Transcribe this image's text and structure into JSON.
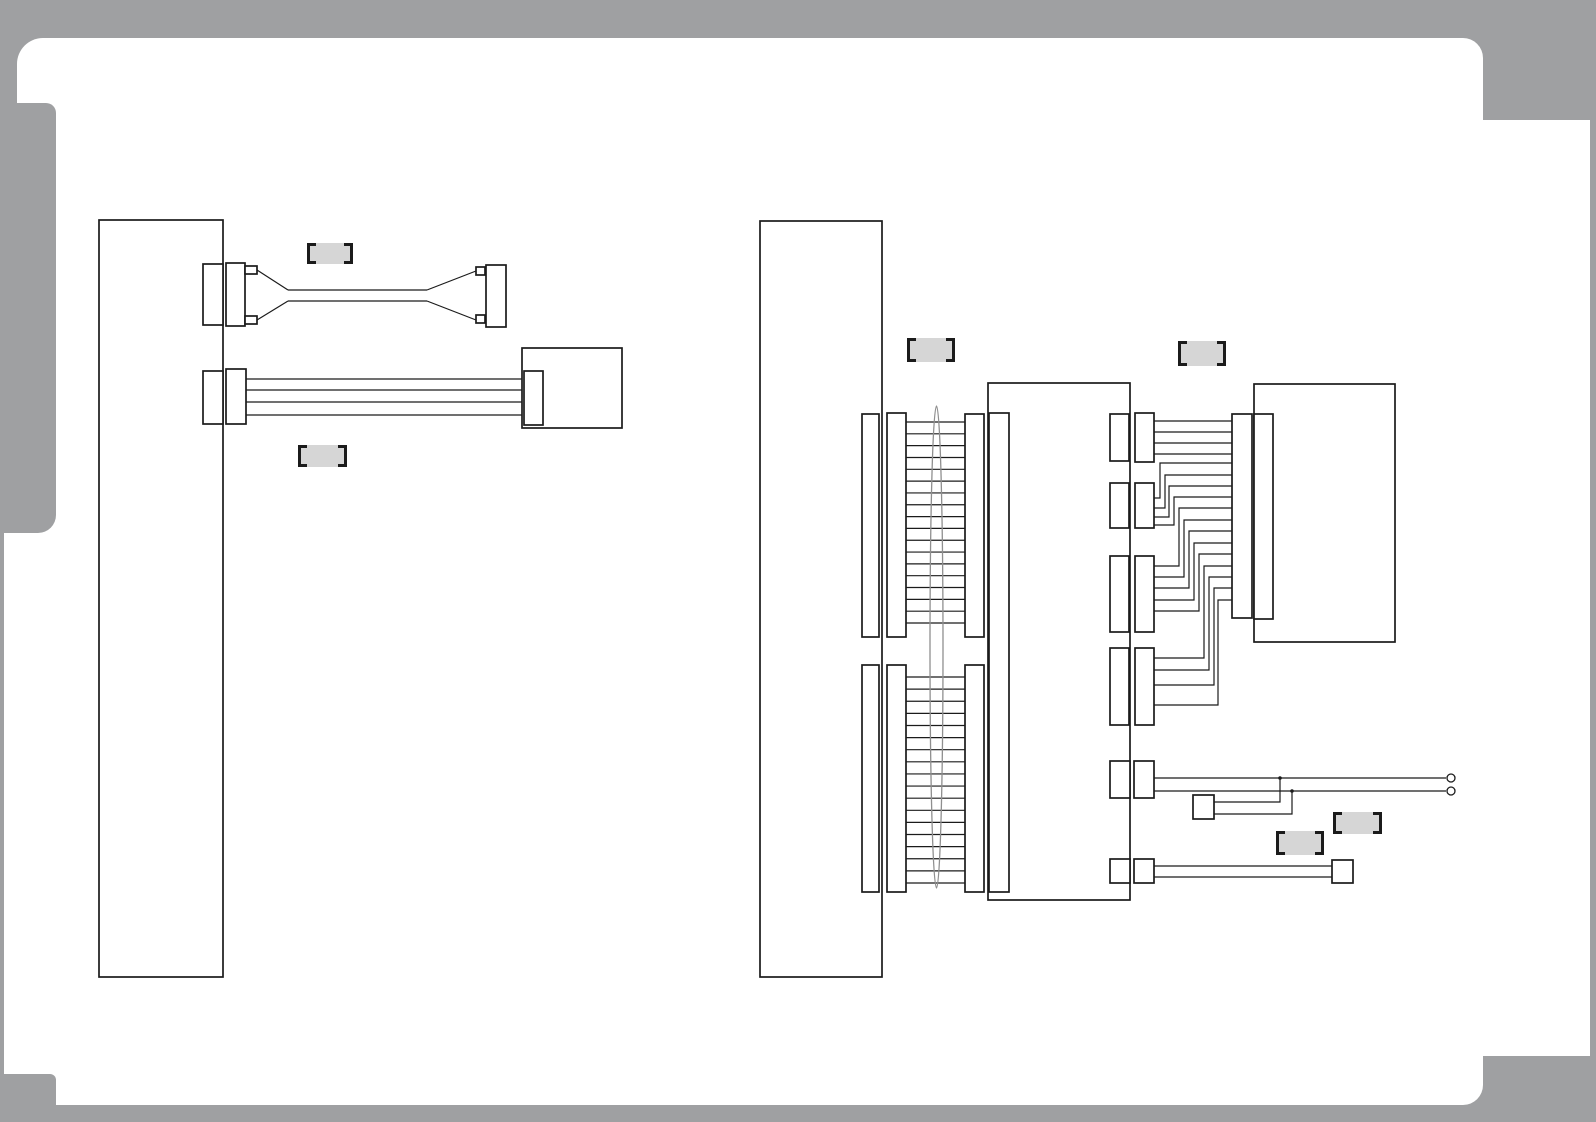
{
  "colors": {
    "background": "#9fa0a2",
    "paper": "#ffffff",
    "line": "#1b1b1b",
    "label_fill": "#d6d6d6",
    "ellipse": "#8f8f8f"
  },
  "labels": [
    {
      "name": "part-label-1",
      "text": "",
      "x": 307,
      "y": 243,
      "w": 46,
      "h": 21
    },
    {
      "name": "part-label-2",
      "text": "",
      "x": 298,
      "y": 445,
      "w": 49,
      "h": 22
    },
    {
      "name": "part-label-3",
      "text": "",
      "x": 907,
      "y": 338,
      "w": 48,
      "h": 24
    },
    {
      "name": "part-label-4",
      "text": "",
      "x": 1178,
      "y": 341,
      "w": 48,
      "h": 25
    },
    {
      "name": "part-label-5",
      "text": "",
      "x": 1333,
      "y": 812,
      "w": 49,
      "h": 22
    },
    {
      "name": "part-label-6",
      "text": "",
      "x": 1276,
      "y": 831,
      "w": 48,
      "h": 24
    }
  ],
  "left_assembly": {
    "ribbon_wire_levels": [
      379,
      390,
      402,
      415
    ],
    "ribbon_x": [
      246,
      524
    ],
    "pair_cable_levels": [
      290,
      301
    ],
    "pair_cable_x": [
      288,
      427
    ]
  },
  "right_assembly": {
    "ribbon_sections": [
      {
        "x1": 906,
        "x2": 965,
        "y_start": 422,
        "y_end": 623,
        "rungs": 18
      },
      {
        "x1": 906,
        "x2": 965,
        "y_start": 677,
        "y_end": 883,
        "rungs": 18
      }
    ],
    "harness_wires": [
      [
        [
          1154,
          421
        ],
        [
          1232,
          421
        ]
      ],
      [
        [
          1154,
          432
        ],
        [
          1232,
          432
        ]
      ],
      [
        [
          1154,
          443
        ],
        [
          1232,
          443
        ]
      ],
      [
        [
          1154,
          454
        ],
        [
          1232,
          454
        ]
      ],
      [
        [
          1154,
          498
        ],
        [
          1160,
          498
        ],
        [
          1160,
          463
        ],
        [
          1232,
          463
        ]
      ],
      [
        [
          1154,
          508
        ],
        [
          1165,
          508
        ],
        [
          1165,
          475
        ],
        [
          1232,
          475
        ]
      ],
      [
        [
          1154,
          517
        ],
        [
          1169,
          517
        ],
        [
          1169,
          486
        ],
        [
          1232,
          486
        ]
      ],
      [
        [
          1154,
          525
        ],
        [
          1174,
          525
        ],
        [
          1174,
          497
        ],
        [
          1232,
          497
        ]
      ],
      [
        [
          1154,
          566
        ],
        [
          1179,
          566
        ],
        [
          1179,
          508
        ],
        [
          1232,
          508
        ]
      ],
      [
        [
          1154,
          577
        ],
        [
          1184,
          577
        ],
        [
          1184,
          520
        ],
        [
          1232,
          520
        ]
      ],
      [
        [
          1154,
          588
        ],
        [
          1189,
          588
        ],
        [
          1189,
          531
        ],
        [
          1232,
          531
        ]
      ],
      [
        [
          1154,
          600
        ],
        [
          1194,
          600
        ],
        [
          1194,
          543
        ],
        [
          1232,
          543
        ]
      ],
      [
        [
          1154,
          611
        ],
        [
          1199,
          611
        ],
        [
          1199,
          554
        ],
        [
          1232,
          554
        ]
      ],
      [
        [
          1154,
          658
        ],
        [
          1204,
          658
        ],
        [
          1204,
          566
        ],
        [
          1232,
          566
        ]
      ],
      [
        [
          1154,
          670
        ],
        [
          1209,
          670
        ],
        [
          1209,
          577
        ],
        [
          1232,
          577
        ]
      ],
      [
        [
          1154,
          685
        ],
        [
          1214,
          685
        ],
        [
          1214,
          588
        ],
        [
          1232,
          588
        ]
      ],
      [
        [
          1154,
          705
        ],
        [
          1218,
          705
        ],
        [
          1218,
          600
        ],
        [
          1232,
          600
        ]
      ]
    ],
    "open_lead_wires": [
      [
        [
          1154,
          778
        ],
        [
          1446,
          778
        ]
      ],
      [
        [
          1154,
          791
        ],
        [
          1446,
          791
        ]
      ]
    ],
    "open_lead_terminals": [
      [
        1451,
        778
      ],
      [
        1451,
        791
      ]
    ],
    "tap_wires": [
      [
        [
          1214,
          802
        ],
        [
          1280,
          802
        ],
        [
          1280,
          778
        ]
      ],
      [
        [
          1214,
          814
        ],
        [
          1292,
          814
        ],
        [
          1292,
          791
        ]
      ]
    ],
    "tap_junctions": [
      [
        1280,
        778
      ],
      [
        1292,
        791
      ]
    ],
    "bottom_lead_wires": [
      [
        [
          1154,
          866
        ],
        [
          1332,
          866
        ]
      ],
      [
        [
          1154,
          877
        ],
        [
          1332,
          877
        ]
      ]
    ]
  }
}
